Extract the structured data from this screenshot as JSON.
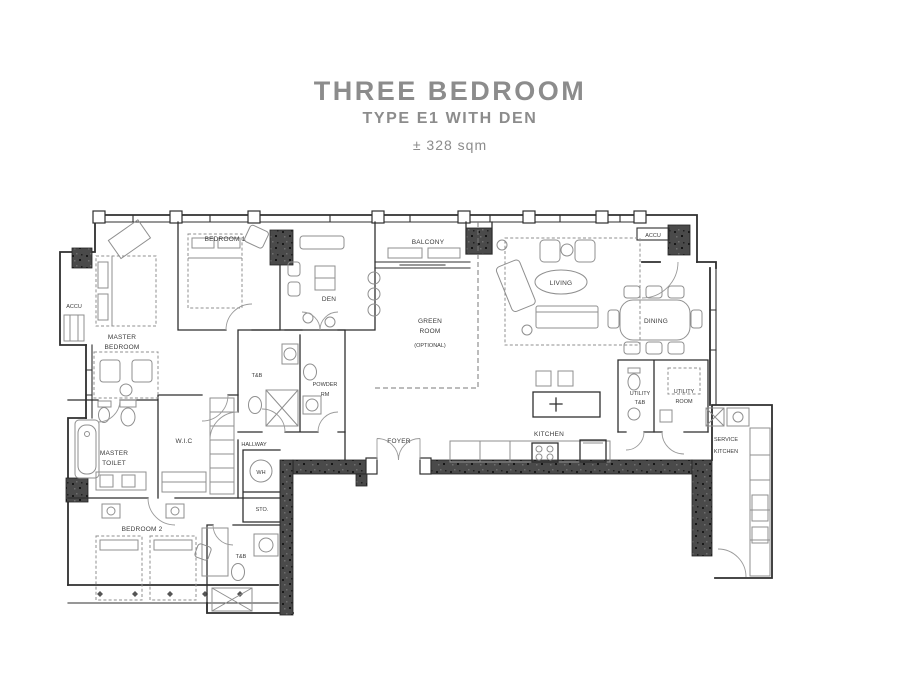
{
  "title": {
    "line1": "THREE BEDROOM",
    "line2": "TYPE E1 WITH DEN",
    "area": "± 328 sqm"
  },
  "colors": {
    "title_gray": "#8c8c8c",
    "wall": "#2f2f2f",
    "concrete_wall": "#4a4a4a",
    "furniture": "#8f8f8f"
  },
  "rooms": {
    "master_bedroom_l1": "MASTER",
    "master_bedroom_l2": "BEDROOM",
    "bedroom1": "BEDROOM 1",
    "bedroom2": "BEDROOM 2",
    "den": "DEN",
    "balcony": "BALCONY",
    "green_room_l1": "GREEN",
    "green_room_l2": "ROOM",
    "green_room_l3": "(OPTIONAL)",
    "living": "LIVING",
    "dining": "DINING",
    "accu_right": "ACCU",
    "accu_left": "ACCU",
    "utility_tb_l1": "UTILITY",
    "utility_tb_l2": "T&B",
    "utility_room_l1": "UTILITY",
    "utility_room_l2": "ROOM",
    "service_kitchen_l1": "SERVICE",
    "service_kitchen_l2": "KITCHEN",
    "kitchen": "KITCHEN",
    "foyer": "FOYER",
    "hallway": "HALLWAY",
    "water_heater": "WH",
    "storage": "STO.",
    "wic": "W.I.C",
    "master_toilet_l1": "MASTER",
    "master_toilet_l2": "TOILET",
    "tb_main": "T&B",
    "powder_l1": "POWDER",
    "powder_l2": "RM",
    "tb_bed2": "T&B"
  }
}
